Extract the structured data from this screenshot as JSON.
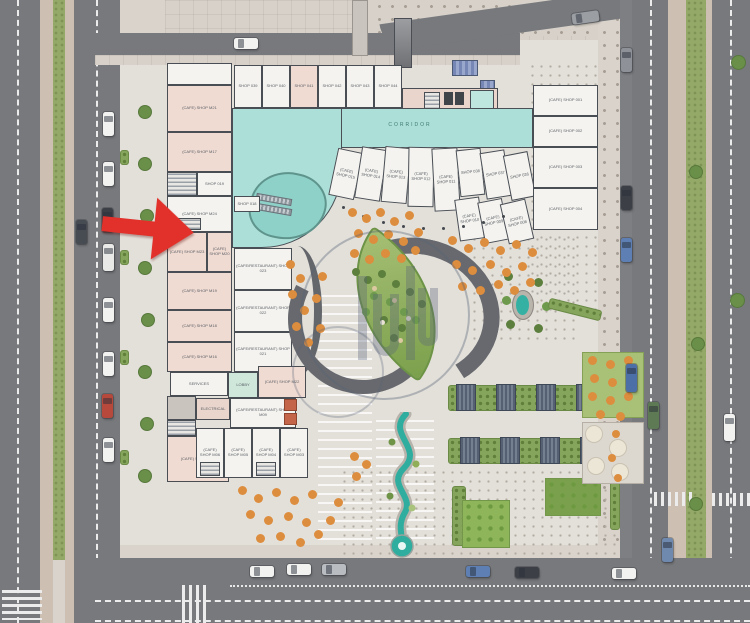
{
  "colors": {
    "arrow": "#e2302a",
    "road": "#77797d",
    "sidewalk": "#d9d3cc",
    "paver": "#cdbfb1",
    "green_strip": "#94a968",
    "corridor_teal": "#abdfd8",
    "shop_white": "#f4f3ef",
    "cafe_pink": "#f0dbd2",
    "wall": "#494e55",
    "plaza": "#e3e0da",
    "water": "#2fae9f",
    "umbrella_orange": "#dd8d3e",
    "lawn": "#8fb55a",
    "pergola_slate": "#5b6777"
  },
  "icons": {
    "marker": "red-location-arrow",
    "watermark": "developer-logo-circle"
  },
  "building": {
    "corridor_label": "CORRIDOR",
    "top_shops": [
      "SHOP 039",
      "SHOP 040",
      "SHOP 041",
      "SHOP 042",
      "SHOP 043",
      "SHOP 044"
    ],
    "fan_shops_top": [
      "(CAFE) SHOP 015",
      "(CAFE) SHOP 014",
      "(CAFE) SHOP 013",
      "(CAFE) SHOP 012",
      "(CAFE) SHOP 011",
      "SHOP 038",
      "SHOP 037",
      "SHOP 036"
    ],
    "fan_shops_bottom": [
      "(CAFE) SHOP 010",
      "(CAFE) SHOP 009",
      "(CAFE) SHOP 008"
    ],
    "right_shops": [
      "(CAFE) SHOP 001",
      "(CAFE) SHOP 002",
      "(CAFE) SHOP 003",
      "(CAFE) SHOP 004"
    ],
    "left_shops": [
      "(CAFE) SHOP M21",
      "(CAFE) SHOP M17",
      "(CAFE) SHOP M24",
      "(CAFE) SHOP M23",
      "(CAFE) SHOP M20",
      "(CAFE) SHOP M19",
      "(CAFE) SHOP M18",
      "(CAFE) SHOP M16"
    ],
    "left_small_shops": [
      "SHOP 019",
      "SHOP 018"
    ],
    "mid_restaurants": [
      "(CAFE/RESTAURANT) SHOP 023",
      "(CAFE/RESTAURANT) SHOP 022",
      "(CAFE/RESTAURANT) SHOP 021"
    ],
    "services_label": "SERVICES",
    "lobby_label": "LOBBY",
    "electrical_label": "ELECTRICAL",
    "restaurant_m09": "(CAFE/RESTAURANT) SHOP M09",
    "cafe_m22": "(CAFE) SHOP M22",
    "cafe_m07": "(CAFE) SHOP M07",
    "bottom_row_shops": [
      "(CAFE) SHOP M06",
      "(CAFE) SHOP M05",
      "(CAFE) SHOP M04",
      "(CAFE) SHOP M03"
    ]
  }
}
